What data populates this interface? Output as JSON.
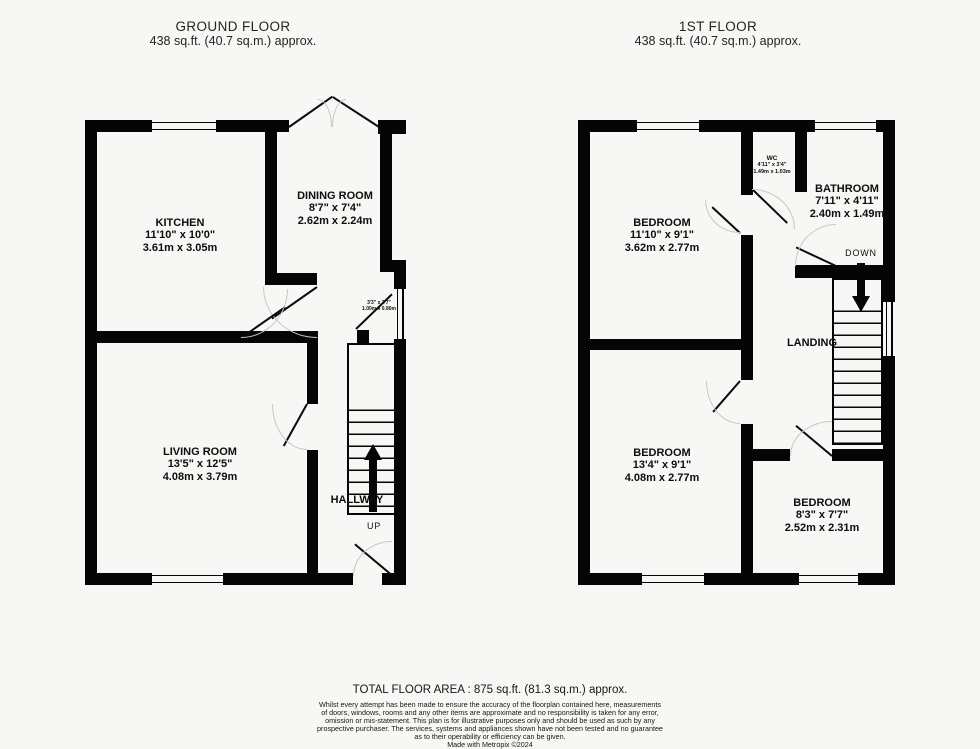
{
  "gf": {
    "title": "GROUND FLOOR",
    "area": "438 sq.ft. (40.7 sq.m.) approx.",
    "rooms": {
      "kitchen": {
        "name": "KITCHEN",
        "imp": "11'10\" x 10'0\"",
        "met": "3.61m x 3.05m"
      },
      "dining": {
        "name": "DINING ROOM",
        "imp": "8'7\" x 7'4\"",
        "met": "2.62m x 2.24m"
      },
      "living": {
        "name": "LIVING ROOM",
        "imp": "13'5\" x 12'5\"",
        "met": "4.08m x 3.79m"
      }
    },
    "hallway": {
      "label": "HALLWAY",
      "up": "UP"
    },
    "store": {
      "imp": "3'3\" x 2'7\"",
      "met": "1.00m x 0.80m"
    }
  },
  "ff": {
    "title": "1ST FLOOR",
    "area": "438 sq.ft. (40.7 sq.m.) approx.",
    "rooms": {
      "bedroom1": {
        "name": "BEDROOM",
        "imp": "11'10\" x 9'1\"",
        "met": "3.62m x 2.77m"
      },
      "bedroom2": {
        "name": "BEDROOM",
        "imp": "13'4\" x 9'1\"",
        "met": "4.08m x 2.77m"
      },
      "bedroom3": {
        "name": "BEDROOM",
        "imp": "8'3\" x 7'7\"",
        "met": "2.52m x 2.31m"
      },
      "wc": {
        "name": "WC",
        "imp": "4'11\" x 3'4\"",
        "met": "1.49m x 1.03m"
      },
      "bathroom": {
        "name": "BATHROOM",
        "imp": "7'11\" x 4'11\"",
        "met": "2.40m x 1.49m"
      }
    },
    "landing": {
      "label": "LANDING",
      "down": "DOWN"
    }
  },
  "footer": {
    "total": "TOTAL FLOOR AREA : 875 sq.ft. (81.3 sq.m.) approx.",
    "disclaimer": [
      "Whilst every attempt has been made to ensure the accuracy of the floorplan contained here, measurements",
      "of doors, windows, rooms and any other items are approximate and no responsibility is taken for any error,",
      "omission or mis-statement. This plan is for illustrative purposes only and should be used as such by any",
      "prospective purchaser. The services, systems and appliances shown have not been tested and no guarantee",
      "as to their operability or efficiency can be given."
    ],
    "credit": "Made with Metropix ©2024"
  }
}
